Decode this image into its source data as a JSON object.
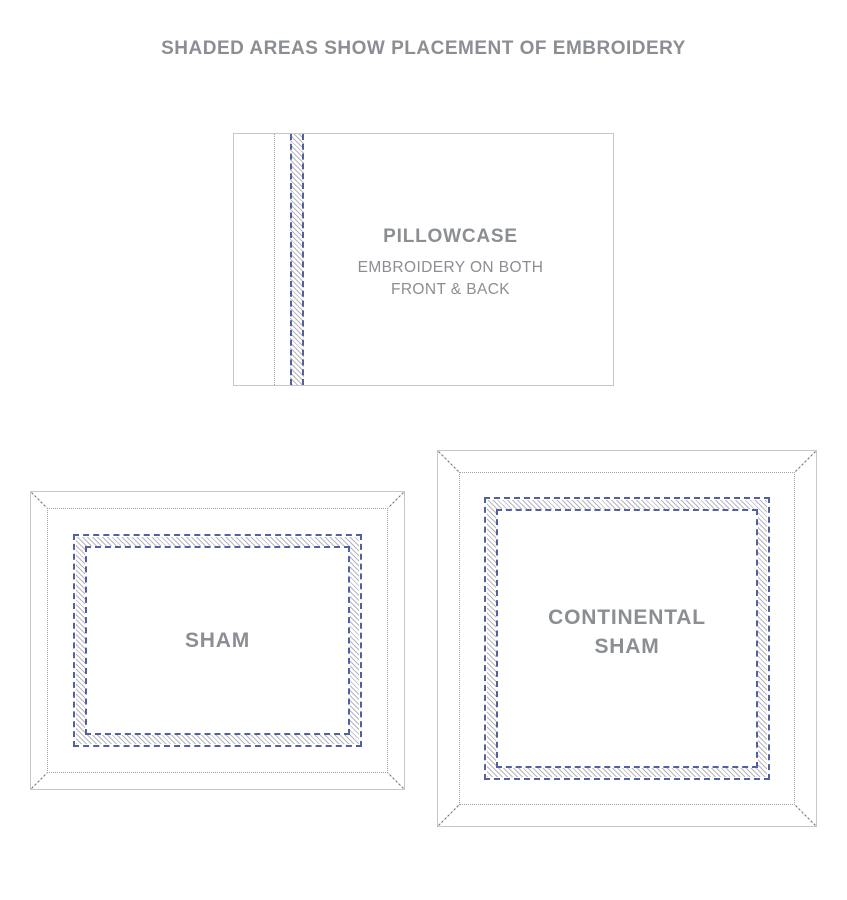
{
  "title": "SHADED AREAS SHOW PLACEMENT OF EMBROIDERY",
  "diagrams": {
    "pillowcase": {
      "label": "PILLOWCASE",
      "note_lines": [
        "EMBROIDERY ON BOTH",
        "FRONT & BACK"
      ]
    },
    "sham": {
      "label": "SHAM"
    },
    "continental_sham": {
      "label_lines": [
        "CONTINENTAL",
        "SHAM"
      ]
    }
  },
  "patterns": {
    "embroidery_area": "diagonal-hatch",
    "embroidery_edge": "blue-dashed-line",
    "flange_stitch": "dotted-line"
  },
  "colors": {
    "background": "#ffffff",
    "text_gray": "#8b8e93",
    "outline_gray": "#c6c6cb",
    "dotted_gray": "#9da2b2",
    "dash_blue": "#5360a0",
    "hatch_gray": "#b5b5bd",
    "miter_gray": "#6f6f7a"
  }
}
